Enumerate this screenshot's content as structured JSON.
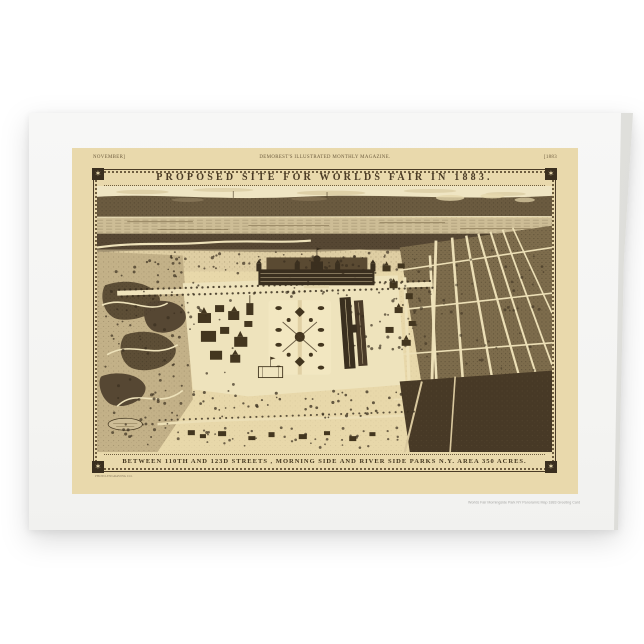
{
  "page": {
    "background": "#ffffff"
  },
  "card": {
    "front_color": "#f5f5f3",
    "fold_color": "#e4e4e1",
    "fine_print": "Worlds Fair Morningside Park NY Panoramic Map 1883 Greeting Card"
  },
  "print": {
    "paper_color": "#e9d9ac",
    "ink_color": "#43361f",
    "header": {
      "left": "NOVEMBER]",
      "center": "DEMOREST'S ILLUSTRATED MONTHLY MAGAZINE.",
      "right": "[1883"
    },
    "frame": {
      "corner_glyph": "✶"
    },
    "title": "PROPOSED  SITE  FOR  WORLDS  FAIR  IN  1883.",
    "caption": "BETWEEN  110TH AND 123D  STREETS , MORNING SIDE AND RIVER SIDE PARKS  N.Y.  AREA 350 ACRES.",
    "engraver_credit": "PHOTO-ENGRAVING CO.",
    "map": {
      "description": "Sepia bird's-eye lithograph of the proposed World's Fair grounds: exhibition palace with domes, formal parterre gardens, long machinery halls, pavilions, Morningside Park cliffs at left, Harlem River and distant shore at top, street grid fanning to the right, wooded Riverside blocks at lower right",
      "palette": {
        "ground": "#e8d8aa",
        "sky": "#efe5c3",
        "water": "#cdbd96",
        "shore": "#564733",
        "building_ink": "#3a2f1f",
        "path_light": "#efe3bc",
        "forest": "#473926"
      }
    }
  }
}
